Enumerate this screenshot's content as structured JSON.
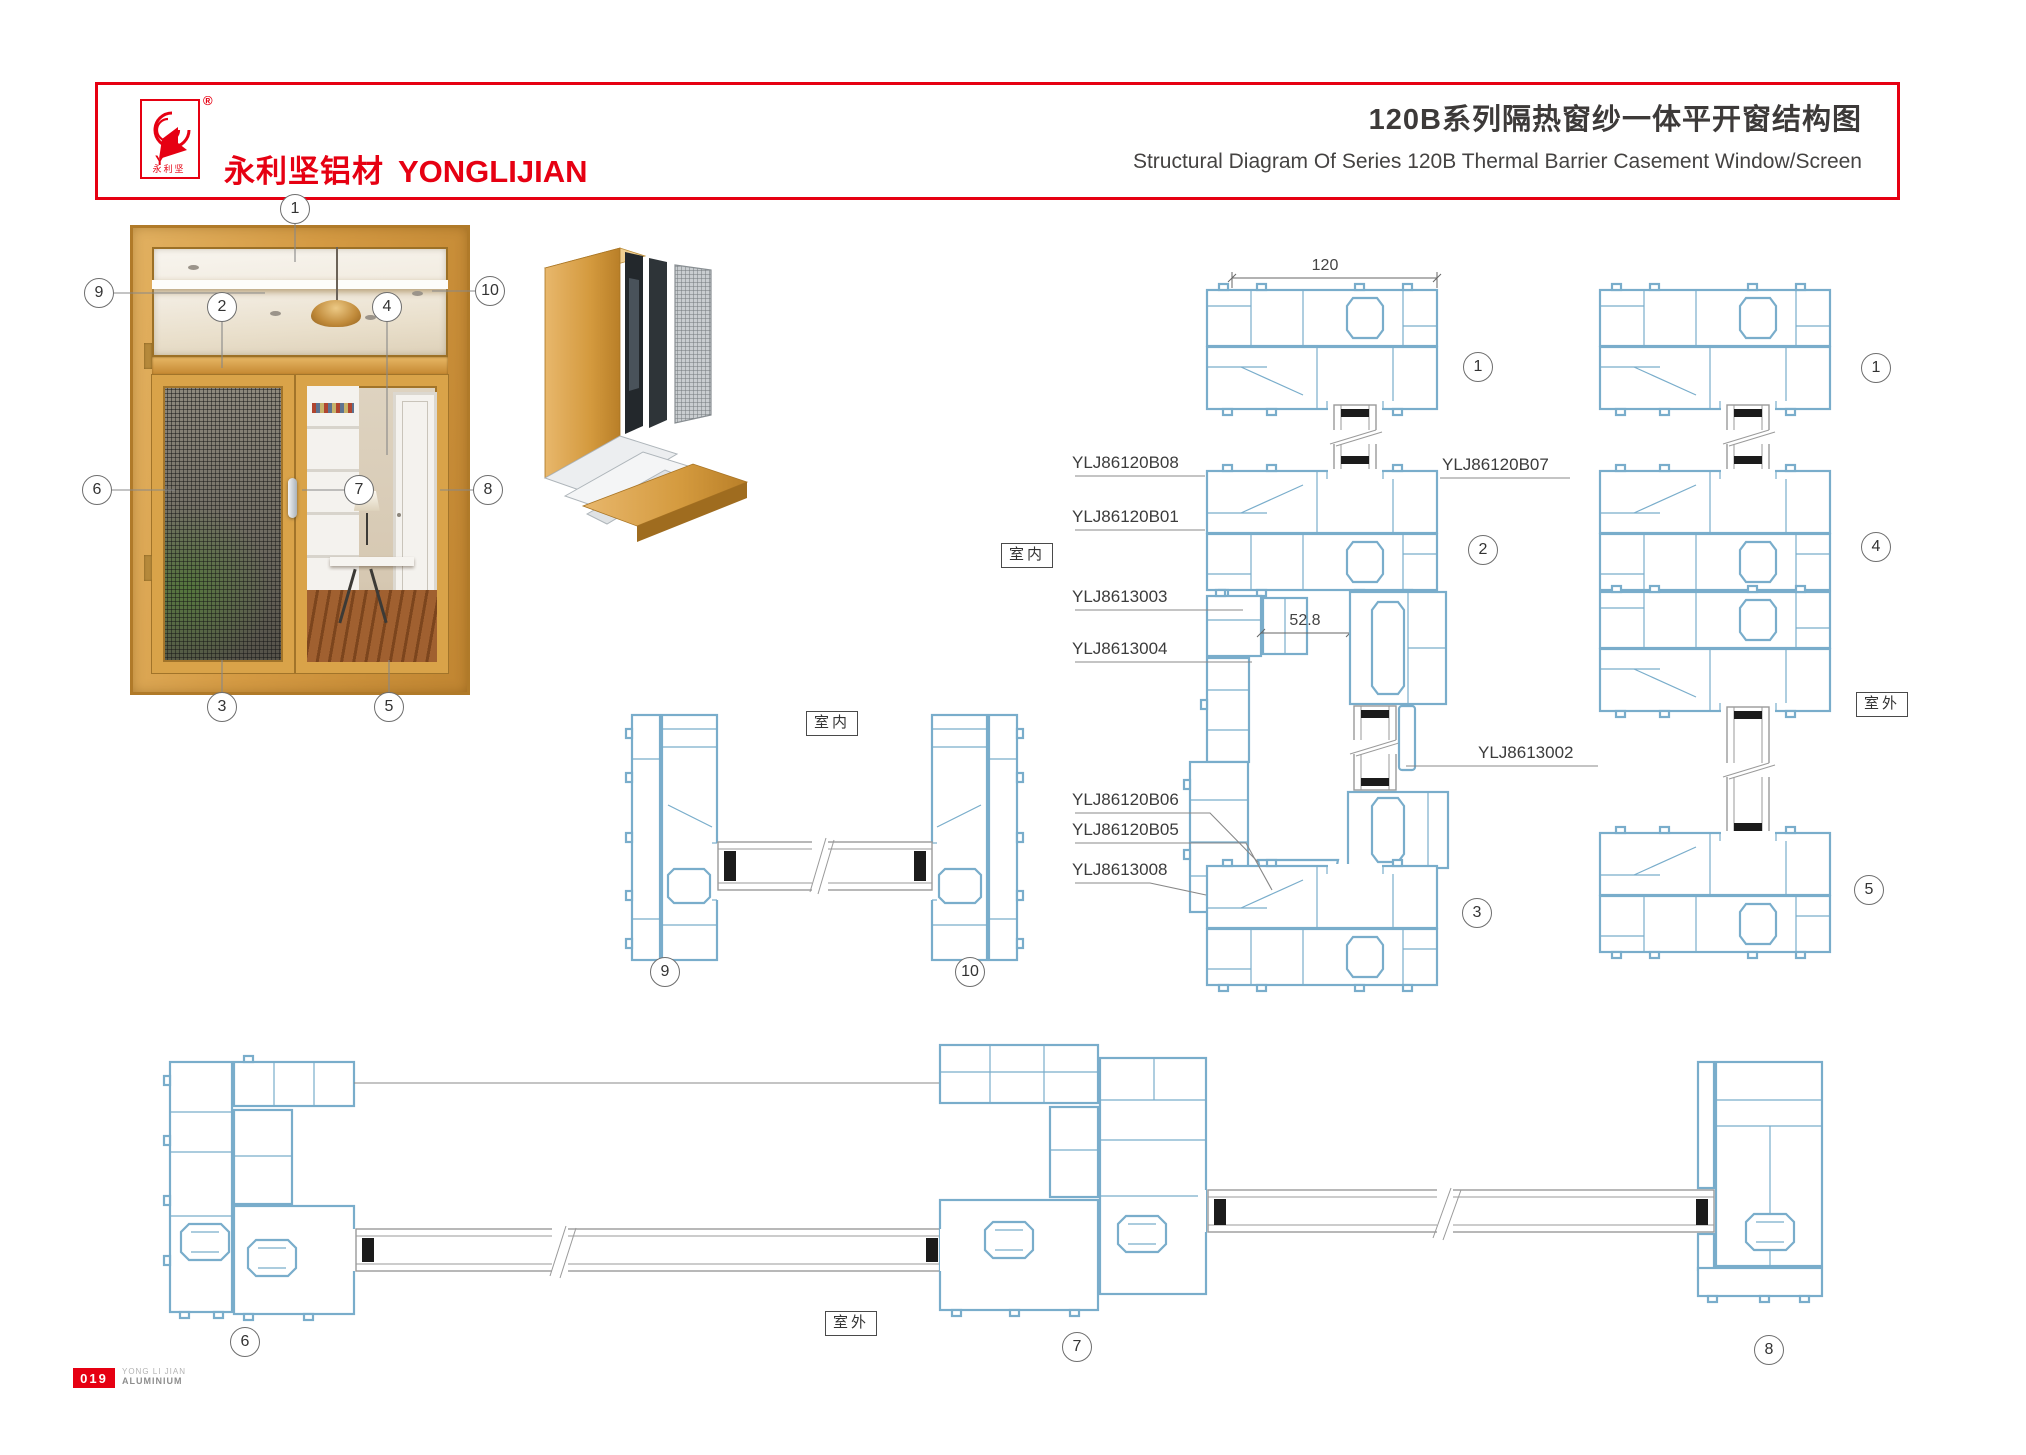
{
  "header": {
    "accent_color": "#e60012",
    "logo_letter": "Y",
    "logo_caption": "永利坚",
    "registered_mark": "®",
    "brand_cn": "永利坚铝材",
    "brand_en": "YONGLIJIAN",
    "title_cn": "120B系列隔热窗纱一体平开窗结构图",
    "title_en": "Structural Diagram Of Series 120B Thermal Barrier Casement Window/Screen"
  },
  "region_labels": {
    "indoor": "室内",
    "outdoor": "室外"
  },
  "dimensions": {
    "frame_width": "120",
    "mullion_gap": "52.8"
  },
  "parts": {
    "left": [
      "YLJ86120B08",
      "YLJ86120B01",
      "YLJ8613003",
      "YLJ8613004",
      "YLJ86120B06",
      "YLJ86120B05",
      "YLJ8613008"
    ],
    "right": [
      "YLJ86120B07",
      "YLJ8613002"
    ]
  },
  "callouts": {
    "window": [
      "1",
      "9",
      "2",
      "4",
      "10",
      "6",
      "7",
      "8",
      "3",
      "5"
    ],
    "jamb_section": [
      "9",
      "10"
    ],
    "middle_column": [
      "1",
      "2",
      "3"
    ],
    "right_column": [
      "1",
      "4",
      "5"
    ],
    "bottom_row": [
      "6",
      "7",
      "8"
    ]
  },
  "footer": {
    "page_number": "019",
    "brand_line1": "YONG LI JIAN",
    "brand_line2": "ALUMINIUM"
  }
}
